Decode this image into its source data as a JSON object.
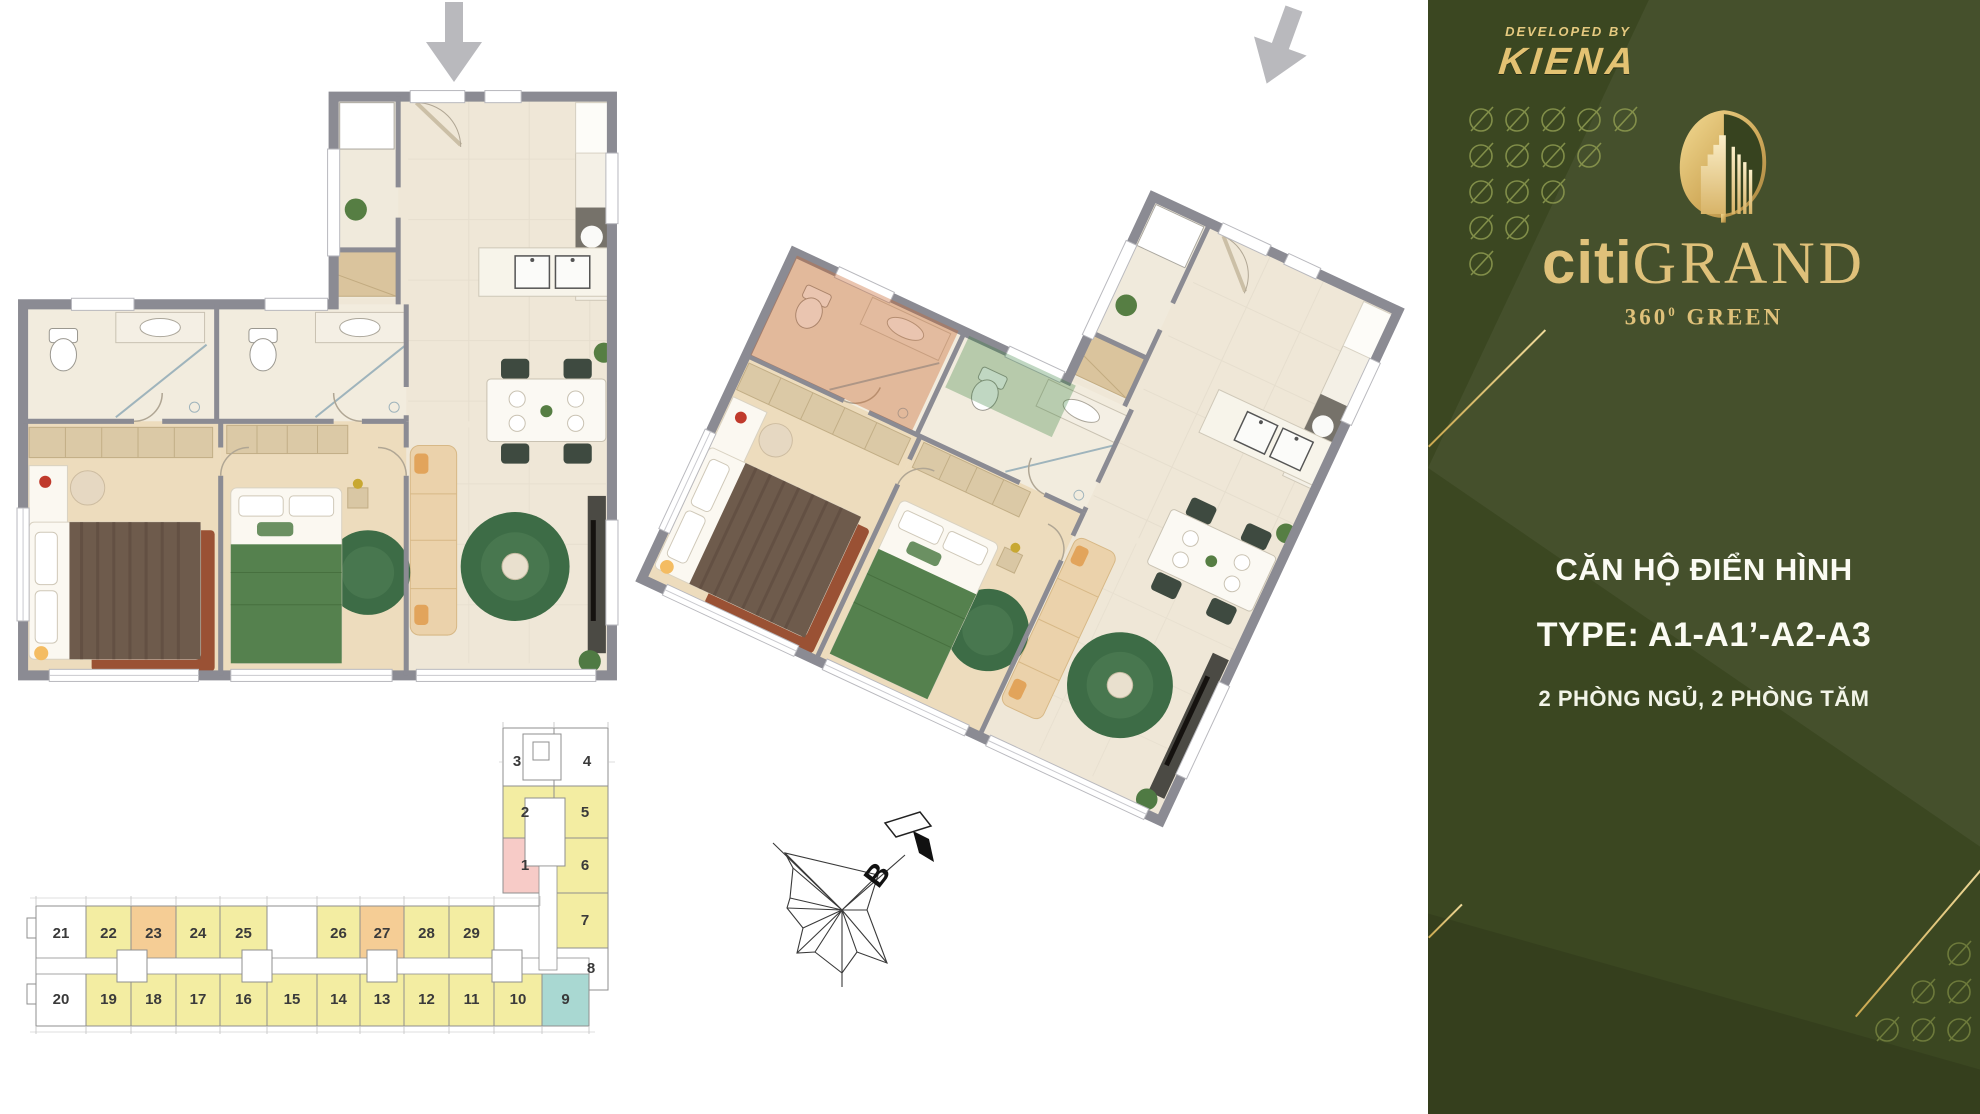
{
  "sidebar": {
    "bg_color": "#3B4721",
    "gold_color": "#DFC17A",
    "developed_by": "DEVELOPED BY",
    "developer": "KIENA",
    "brand": {
      "citi": "citi",
      "grand": "GRAND",
      "deg": "360",
      "deg_sup": "0",
      "green": "GREEN"
    },
    "title": "CĂN HỘ ĐIỂN HÌNH",
    "type_line": "TYPE: A1-A1’-A2-A3",
    "subtitle": "2 PHÒNG NGỦ, 2 PHÒNG TĂM"
  },
  "compass": {
    "north_label": "B"
  },
  "keyplan": {
    "unit_colors": {
      "yellow": "#F3EDA2",
      "orange": "#F5CD95",
      "pink": "#F7CBC7",
      "teal": "#A9D8D2",
      "white": "#FFFFFF"
    },
    "tower": [
      {
        "label": "3",
        "color": "white"
      },
      {
        "label": "4",
        "color": "white"
      },
      {
        "label": "2",
        "color": "yellow"
      },
      {
        "label": "5",
        "color": "yellow"
      },
      {
        "label": "1",
        "color": "pink"
      },
      {
        "label": "6",
        "color": "yellow"
      },
      {
        "label": "7",
        "color": "yellow"
      },
      {
        "label": "8",
        "color": "white"
      }
    ],
    "wing_top": [
      {
        "label": "21",
        "color": "white"
      },
      {
        "label": "22",
        "color": "yellow"
      },
      {
        "label": "23",
        "color": "orange"
      },
      {
        "label": "24",
        "color": "yellow"
      },
      {
        "label": "25",
        "color": "yellow"
      },
      {
        "label": "26",
        "color": "yellow"
      },
      {
        "label": "27",
        "color": "orange"
      },
      {
        "label": "28",
        "color": "yellow"
      },
      {
        "label": "29",
        "color": "yellow"
      }
    ],
    "wing_bottom": [
      {
        "label": "20",
        "color": "white"
      },
      {
        "label": "19",
        "color": "yellow"
      },
      {
        "label": "18",
        "color": "yellow"
      },
      {
        "label": "17",
        "color": "yellow"
      },
      {
        "label": "16",
        "color": "yellow"
      },
      {
        "label": "15",
        "color": "yellow"
      },
      {
        "label": "14",
        "color": "yellow"
      },
      {
        "label": "13",
        "color": "yellow"
      },
      {
        "label": "12",
        "color": "yellow"
      },
      {
        "label": "11",
        "color": "yellow"
      },
      {
        "label": "10",
        "color": "yellow"
      },
      {
        "label": "9",
        "color": "teal"
      }
    ]
  }
}
